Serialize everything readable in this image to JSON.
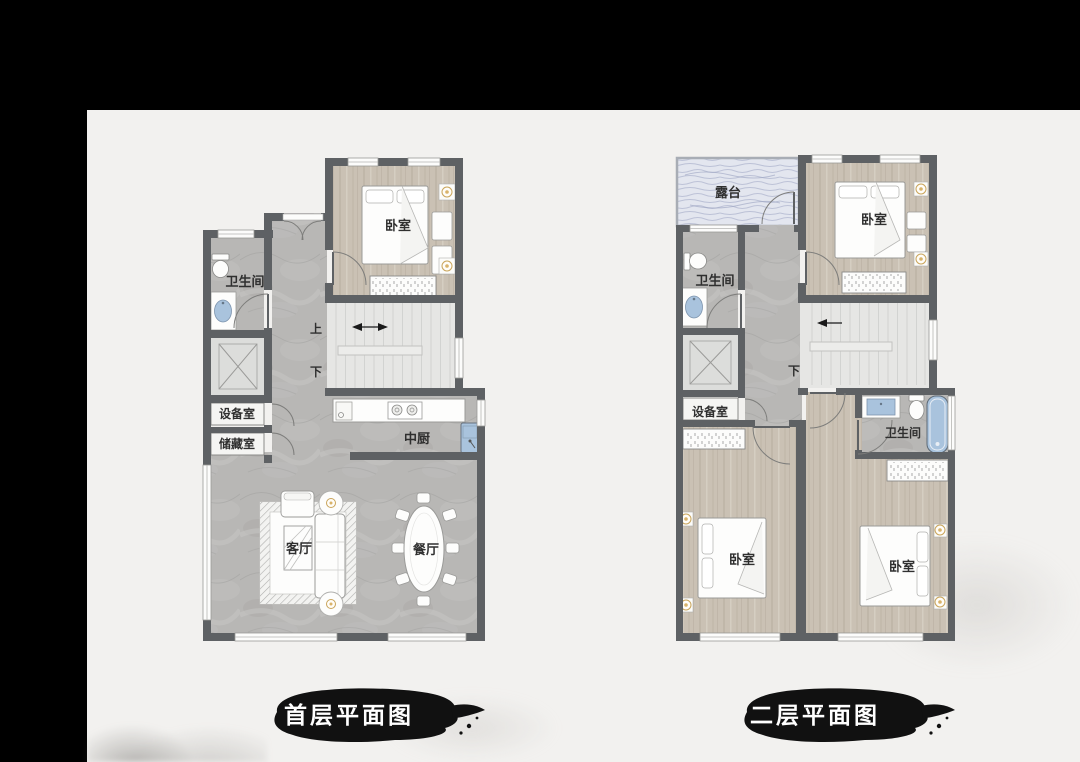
{
  "frame": {
    "color": "#000000",
    "top_bar_height": 110,
    "left_bar_width": 87
  },
  "colors": {
    "background": "#f2f1ef",
    "wall": "#5e6164",
    "marble_floor": "#b8b7b5",
    "wood_floor": "#cac1b4",
    "stair_floor": "#e6e6e4",
    "terrace_floor": "#e3e6ef",
    "fixture_blue": "#a9c3dd",
    "lamp_gold": "#d9b36a",
    "ink_black": "#111111",
    "title_text": "#ffffff"
  },
  "floor1": {
    "title": "首层平面图",
    "labels": {
      "bedroom": "卧室",
      "bathroom": "卫生间",
      "equipment_room": "设备室",
      "storage_room": "储藏室",
      "kitchen": "中厨",
      "living_room": "客厅",
      "dining_room": "餐厅",
      "stair_up": "上",
      "stair_down": "下"
    }
  },
  "floor2": {
    "title": "二层平面图",
    "labels": {
      "terrace": "露台",
      "bedroom_top": "卧室",
      "bedroom_left": "卧室",
      "bedroom_right": "卧室",
      "bathroom_left": "卫生间",
      "bathroom_right": "卫生间",
      "equipment_room": "设备室",
      "stair_down": "下"
    }
  }
}
